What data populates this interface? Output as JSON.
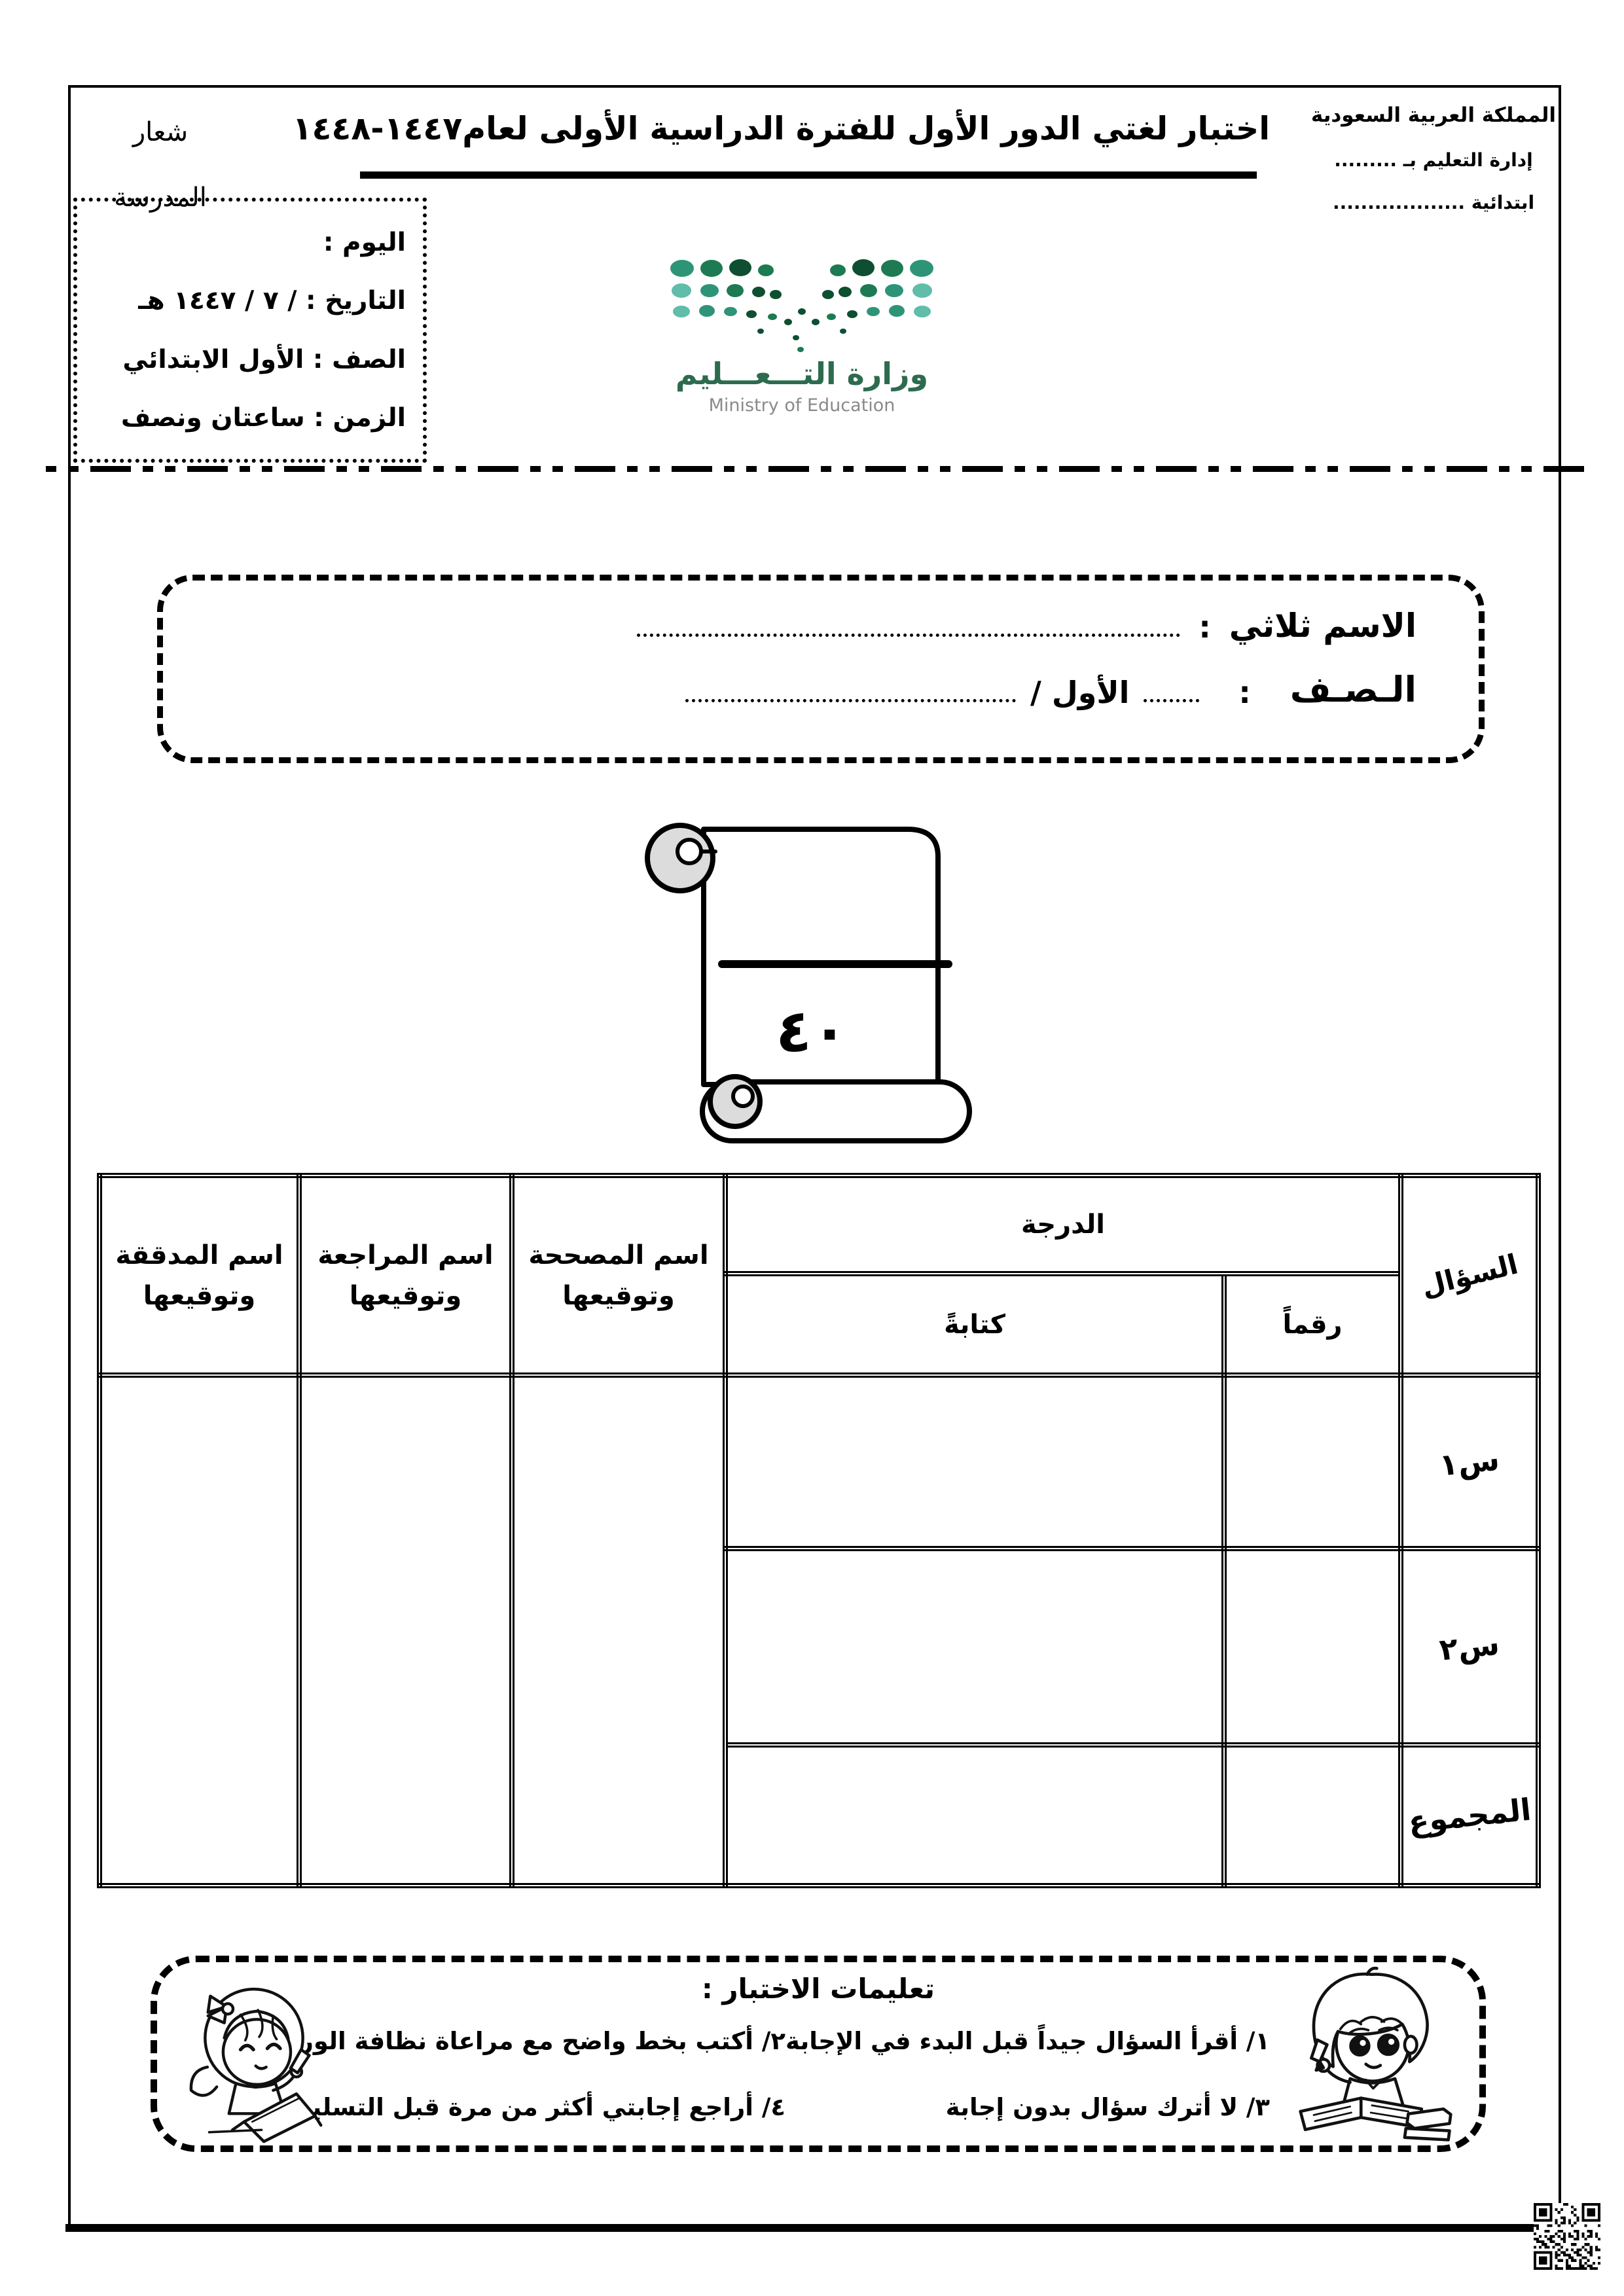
{
  "header": {
    "school_logo": {
      "line1": "شعار",
      "line2": "المدرسة"
    },
    "right_block": {
      "country": "المملكة العربية السعودية",
      "edu_admin": "إدارة التعليم بـ .........",
      "school_type": "ابتدائية ..................."
    },
    "title": "اختبار لغتي الدور الأول للفترة الدراسية الأولى لعام١٤٤٧-١٤٤٨"
  },
  "info_box": {
    "day": "اليوم :",
    "date": "التاريخ :  / ٧ / ١٤٤٧ هـ",
    "grade_class": "الصف : الأول الابتدائي",
    "duration": "الزمن : ساعتان ونصف"
  },
  "ministry": {
    "name_ar": "وزارة التـــعـــليم",
    "name_en": "Ministry of Education"
  },
  "name_box": {
    "name_label": "الاسم ثلاثي",
    "name_colon": ":",
    "class_label": "الـصـف",
    "class_colon": ":",
    "class_value": "الأول /"
  },
  "score_scroll": {
    "total_grade": "٤٠"
  },
  "grade_table": {
    "question_col": "السؤال",
    "grade_col": "الدرجة",
    "written_col": "كتابةً",
    "numeric_col": "رقماً",
    "corrector_col": {
      "line1": "اسم المصححة",
      "line2": "وتوقيعها"
    },
    "reviewer_col": {
      "line1": "اسم المراجعة",
      "line2": "وتوقيعها"
    },
    "auditor_col": {
      "line1": "اسم المدققة",
      "line2": "وتوقيعها"
    },
    "rows": [
      {
        "label": "س١"
      },
      {
        "label": "س٢"
      },
      {
        "label": "المجموع"
      }
    ]
  },
  "instructions": {
    "title": "تعليمات الاختبار :",
    "item1": "١/ أقرأ السؤال جيداً قبل البدء في الإجابة",
    "item2": "٢/ أكتب بخط واضح مع مراعاة نظافة الورقة",
    "item3": "٣/ لا أترك سؤال بدون إجابة",
    "item4": "٤/ أراجع إجابتي أكثر من مرة قبل التسليم"
  },
  "colors": {
    "logo_green": "#2d6b4f",
    "logo_gray": "#8a8a8a",
    "dot_t1": "#5fbdaa",
    "dot_t2": "#2e9478",
    "dot_g1": "#1d7a52",
    "dot_g2": "#0e4f31"
  }
}
